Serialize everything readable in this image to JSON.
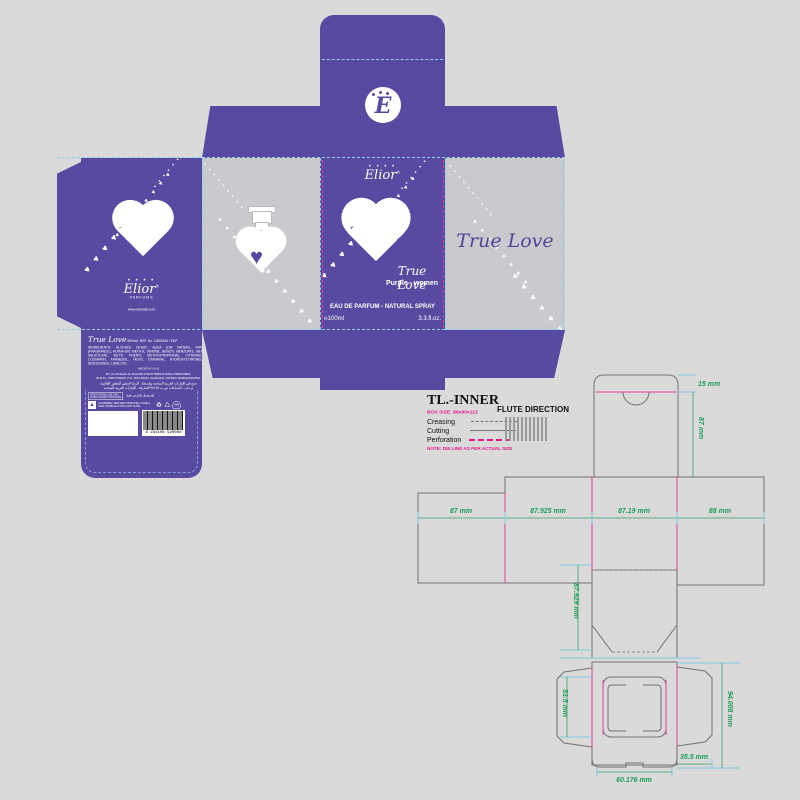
{
  "artwork": {
    "elior": {
      "name": "Elior",
      "reg": "®",
      "sub": "PARFUMS",
      "dots": "• • • •"
    },
    "monogram": "E",
    "heart_word_top": "TRUE",
    "heart_word_bottom": "LOVE",
    "website": "www.etewati.com",
    "front": {
      "script": "True Love",
      "variant": "Purple - women",
      "type_line": "EAU DE PARFUM - NATURAL SPRAY",
      "volume": "℮100ml",
      "floz": "3.3.fl.oz."
    },
    "side": {
      "script": "True Love",
      "code": "AY.X.11"
    },
    "back": {
      "script": "True Love",
      "ref_line": "80%vol.   REF. No. 10001184 / EDP",
      "ingredients": "INGREDIENTS:  ALCOHOL DENAT, AQUA (DM WATER),  PARFUM (FRAGRANCE), ALPHA-ISO METHYL IONONE, BENZYL BENZOATE, BENZYL SALICYLATE, BUTYL PHENYL METHYLPROPIONAL, CITRONELLOL, COUMARIN, FARNESOL, HEXYL CINNAMAL, HYDROXYCITRONELLAL, ISOEUGENOL, LINALOOL.",
      "made_in": "MADE IN U.A.E",
      "producer1": "BY: AL RASHAA AL DAHABI FOR INTERNATIONAL PERFUMES,",
      "producer2": "(M.D.F) - INDUSTRIES, P.O. BOX 38134, SHARJAH, UNITED ARAB EMIRATES.",
      "arabic1": "صنع في الإمارات العربية المتحدة بواسطة : الرشا الذهبي للعطور العالمية",
      "arabic2": "م.د.ف - الصناعات ص.ب ٣٨١٣٤ الشارقة - الإمارات العربية المتحدة",
      "notice1": "FOR EXTERNAL USE ONLY",
      "notice2": "AVOID CONTACT WITH EYES",
      "notice_ar": "للاستعمال الخارجي فقط",
      "flammable": "FLAMMABLE: KEEP AWAY FROM FIRE, FLAME & HEAT. STORE IN A COOL & DRY PLACE.",
      "pao": "36M",
      "barcode": "6 291108 920068"
    }
  },
  "legend": {
    "title": "TL.-INNER",
    "box_size": "BOX SIZE: 88x90x113",
    "creasing": "Creasing",
    "cutting": "Cutting",
    "perforation": "Perforation",
    "note": "NOTE: DIE LINE AS PER ACTUAL SIZE",
    "flute": "FLUTE DIRECTION"
  },
  "dims": {
    "top": "15 mm",
    "flap": "87 mm",
    "w1": "87 mm",
    "w2": "87.925 mm",
    "w3": "87.19 mm",
    "w4": "88 mm",
    "leg": "87.929 mm",
    "lock_left": "53.5 mm",
    "lock_right": "94.008 mm",
    "lock_bottom": "60.176 mm",
    "lock_gap": "35.5 mm"
  },
  "colors": {
    "purple": "#594aa1",
    "silver": "#c9cacd",
    "magenta": "#e23d96",
    "green": "#1c9e58",
    "cyan": "#7fcbe0"
  }
}
